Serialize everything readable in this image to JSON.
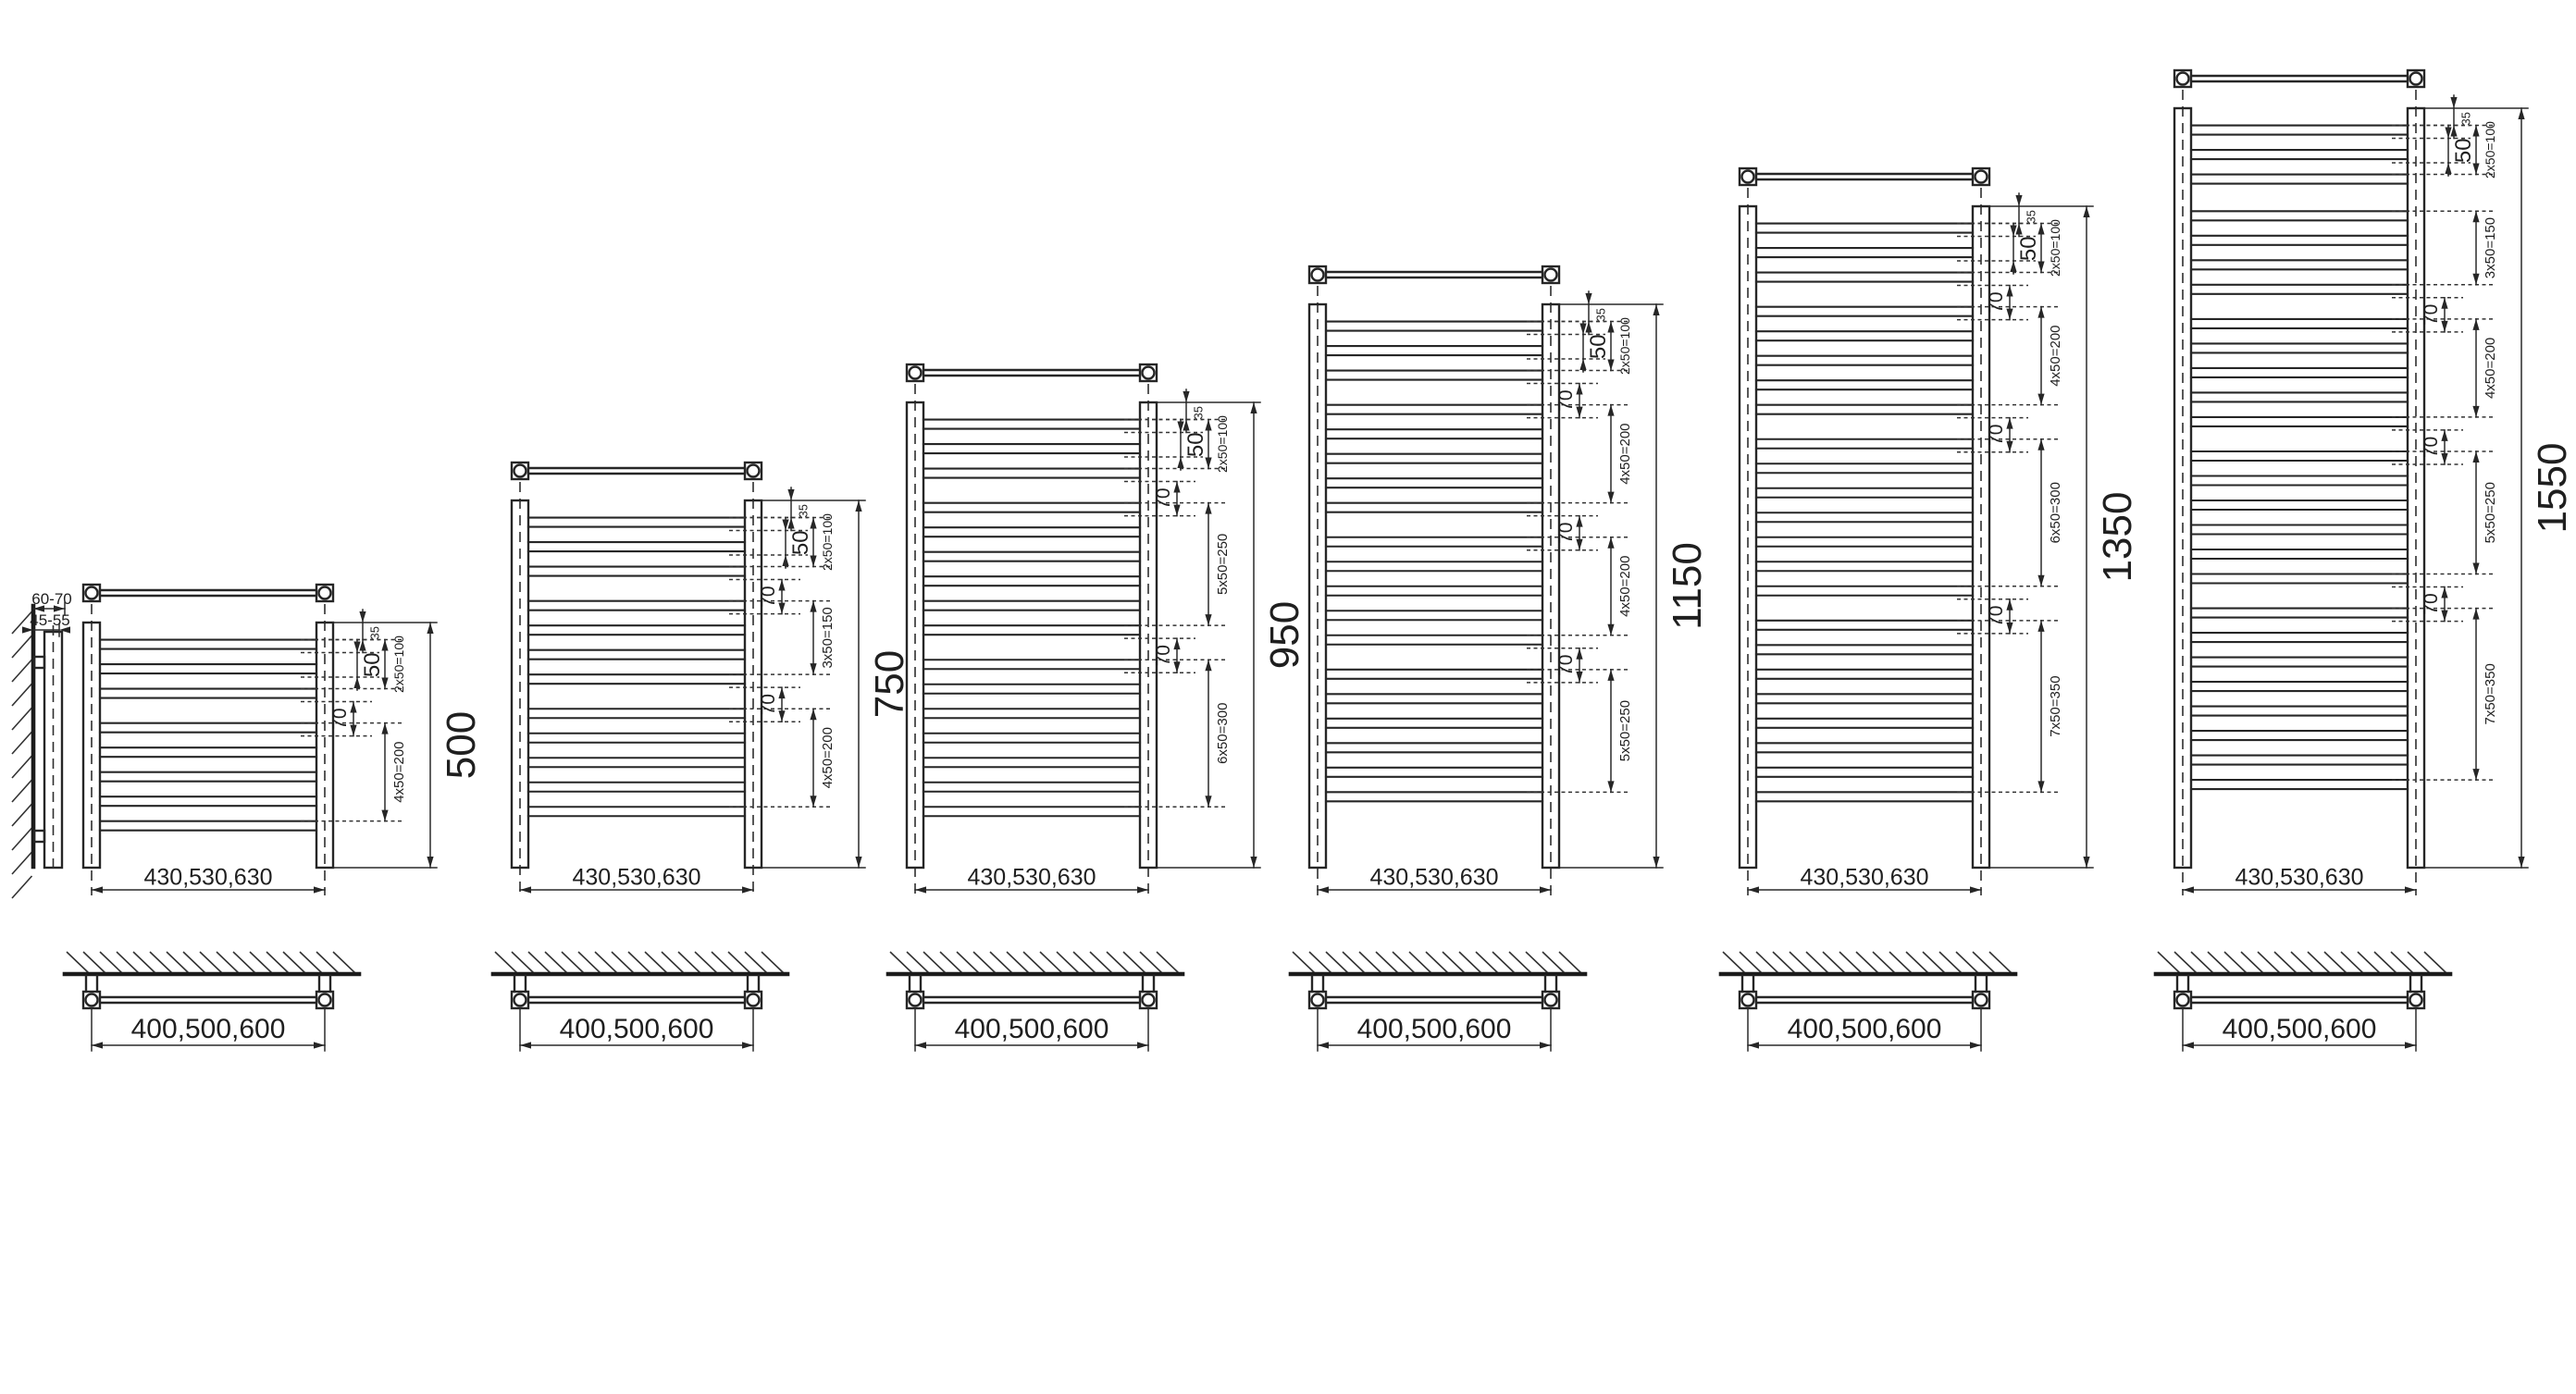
{
  "diagram": {
    "title": "towel-radiator-size-range-dimension-drawing",
    "units": "mm",
    "side_view": {
      "depth_label": "60-70",
      "offset_label": "45-55"
    },
    "radiators": [
      {
        "height_label": "500",
        "height_mm": 500,
        "top_offset_label": "35",
        "pitch_label": "50",
        "tube_width_label": "430,530,630",
        "wall_spacing_label": "400,500,600",
        "sections": [
          {
            "type": "group",
            "tubes": 3,
            "label": "2x50=100"
          },
          {
            "type": "gap",
            "mm": 70,
            "label": "70"
          },
          {
            "type": "group",
            "tubes": 5,
            "label": "4x50=200"
          }
        ]
      },
      {
        "height_label": "750",
        "height_mm": 750,
        "top_offset_label": "35",
        "pitch_label": "50",
        "tube_width_label": "430,530,630",
        "wall_spacing_label": "400,500,600",
        "sections": [
          {
            "type": "group",
            "tubes": 3,
            "label": "2x50=100"
          },
          {
            "type": "gap",
            "mm": 70,
            "label": "70"
          },
          {
            "type": "group",
            "tubes": 4,
            "label": "3x50=150"
          },
          {
            "type": "gap",
            "mm": 70,
            "label": "70"
          },
          {
            "type": "group",
            "tubes": 5,
            "label": "4x50=200"
          }
        ]
      },
      {
        "height_label": "950",
        "height_mm": 950,
        "top_offset_label": "35",
        "pitch_label": "50",
        "tube_width_label": "430,530,630",
        "wall_spacing_label": "400,500,600",
        "sections": [
          {
            "type": "group",
            "tubes": 3,
            "label": "2x50=100"
          },
          {
            "type": "gap",
            "mm": 70,
            "label": "70"
          },
          {
            "type": "group",
            "tubes": 6,
            "label": "5x50=250"
          },
          {
            "type": "gap",
            "mm": 70,
            "label": "70"
          },
          {
            "type": "group",
            "tubes": 7,
            "label": "6x50=300"
          }
        ]
      },
      {
        "height_label": "1150",
        "height_mm": 1150,
        "top_offset_label": "35",
        "pitch_label": "50",
        "tube_width_label": "430,530,630",
        "wall_spacing_label": "400,500,600",
        "sections": [
          {
            "type": "group",
            "tubes": 3,
            "label": "2x50=100"
          },
          {
            "type": "gap",
            "mm": 70,
            "label": "70"
          },
          {
            "type": "group",
            "tubes": 5,
            "label": "4x50=200"
          },
          {
            "type": "gap",
            "mm": 70,
            "label": "70"
          },
          {
            "type": "group",
            "tubes": 5,
            "label": "4x50=200"
          },
          {
            "type": "gap",
            "mm": 70,
            "label": "70"
          },
          {
            "type": "group",
            "tubes": 6,
            "label": "5x50=250"
          }
        ]
      },
      {
        "height_label": "1350",
        "height_mm": 1350,
        "top_offset_label": "35",
        "pitch_label": "50",
        "tube_width_label": "430,530,630",
        "wall_spacing_label": "400,500,600",
        "sections": [
          {
            "type": "group",
            "tubes": 3,
            "label": "2x50=100"
          },
          {
            "type": "gap",
            "mm": 70,
            "label": "70"
          },
          {
            "type": "group",
            "tubes": 5,
            "label": "4x50=200"
          },
          {
            "type": "gap",
            "mm": 70,
            "label": "70"
          },
          {
            "type": "group",
            "tubes": 7,
            "label": "6x50=300"
          },
          {
            "type": "gap",
            "mm": 70,
            "label": "70"
          },
          {
            "type": "group",
            "tubes": 8,
            "label": "7x50=350"
          }
        ]
      },
      {
        "height_label": "1550",
        "height_mm": 1550,
        "top_offset_label": "35",
        "pitch_label": "50",
        "tube_width_label": "430,530,630",
        "wall_spacing_label": "400,500,600",
        "sections": [
          {
            "type": "group",
            "tubes": 3,
            "label": "2x50=100"
          },
          {
            "type": "gap",
            "mm": 75,
            "label": ""
          },
          {
            "type": "group",
            "tubes": 4,
            "label": "3x50=150"
          },
          {
            "type": "gap",
            "mm": 70,
            "label": "70"
          },
          {
            "type": "group",
            "tubes": 5,
            "label": "4x50=200"
          },
          {
            "type": "gap",
            "mm": 70,
            "label": "70"
          },
          {
            "type": "group",
            "tubes": 6,
            "label": "5x50=250"
          },
          {
            "type": "gap",
            "mm": 70,
            "label": "70"
          },
          {
            "type": "group",
            "tubes": 8,
            "label": "7x50=350"
          }
        ]
      }
    ]
  }
}
